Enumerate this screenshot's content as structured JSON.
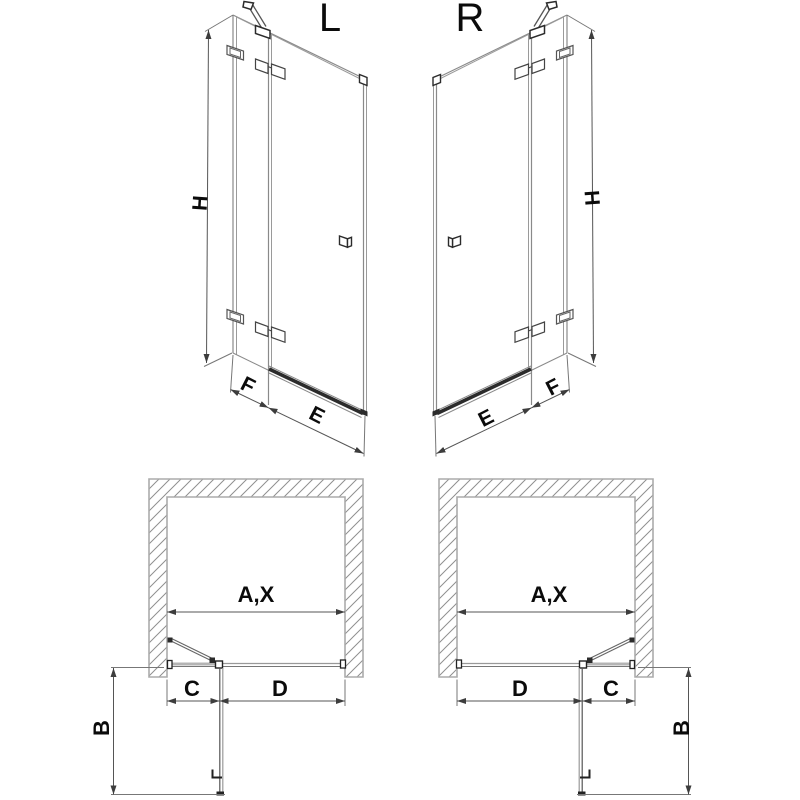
{
  "views": {
    "left_3d": {
      "variant_label": "L",
      "height_label": "H",
      "fixed_panel_label": "F",
      "door_label": "E"
    },
    "right_3d": {
      "variant_label": "R",
      "height_label": "H",
      "fixed_panel_label": "F",
      "door_label": "E"
    },
    "left_plan": {
      "opening_label": "A,X",
      "fixed_segment_label": "C",
      "door_segment_label": "D",
      "projection_label": "B"
    },
    "right_plan": {
      "opening_label": "A,X",
      "fixed_segment_label": "C",
      "door_segment_label": "D",
      "projection_label": "B"
    }
  },
  "colors": {
    "background": "#ffffff",
    "construction_line": "#8a8a8a",
    "glass_line": "#9a9a9a",
    "dark_hardware": "#2b2b2b",
    "dimension_line": "#555555",
    "wall_outline": "#ababab",
    "wall_hatch": "#8f8f8f",
    "text": "#0b0b0b"
  }
}
